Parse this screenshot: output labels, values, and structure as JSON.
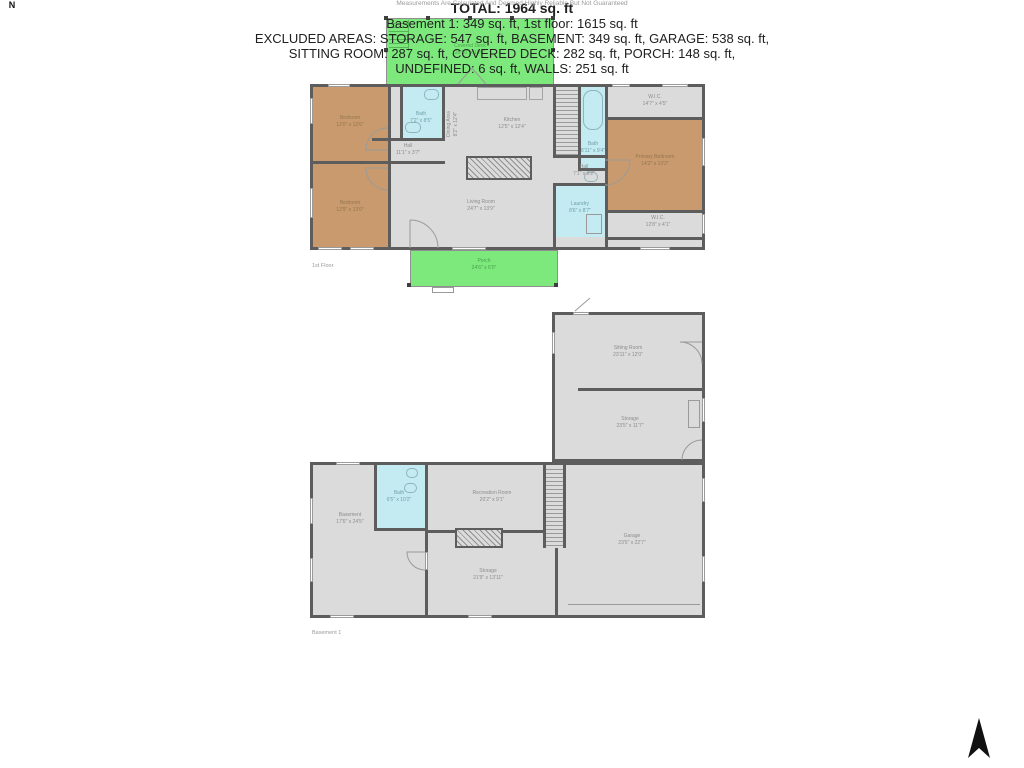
{
  "page": {
    "floor1_label": "1st Floor",
    "basement_label": "Basement 1"
  },
  "floor1": {
    "rooms": {
      "covered_deck": {
        "name": "Covered Deck",
        "dims": "26'10\" x 10'6\""
      },
      "bedroom_top": {
        "name": "Bedroom",
        "dims": "12'0\" x 12'6\""
      },
      "bath_left": {
        "name": "Bath",
        "dims": "7'2\" x 8'5\""
      },
      "hall_left": {
        "name": "Hall",
        "dims": "11'1\" x 3'7\""
      },
      "dining_area": {
        "name": "Dining Area",
        "dims": "8'2\" x 12'4\""
      },
      "kitchen": {
        "name": "Kitchen",
        "dims": "12'5\" x 12'4\""
      },
      "bath_right": {
        "name": "Bath",
        "dims": "8'11\" x 9'4\""
      },
      "wic_top": {
        "name": "W.I.C.",
        "dims": "14'7\" x 4'5\""
      },
      "primary_bedroom": {
        "name": "Primary Bedroom",
        "dims": "14'2\" x 13'2\""
      },
      "wic_bottom": {
        "name": "W.I.C.",
        "dims": "12'8\" x 4'1\""
      },
      "hall_right": {
        "name": "Hall",
        "dims": "7'1\" x 6'2\""
      },
      "laundry": {
        "name": "Laundry",
        "dims": "8'6\" x 8'7\""
      },
      "living_room": {
        "name": "Living Room",
        "dims": "24'7\" x 13'9\""
      },
      "bedroom_bottom": {
        "name": "Bedroom",
        "dims": "12'9\" x 13'0\""
      },
      "porch": {
        "name": "Porch",
        "dims": "24'6\" x 6'0\""
      }
    }
  },
  "basement": {
    "rooms": {
      "sitting_room": {
        "name": "Sitting Room",
        "dims": "23'11\" x 12'0\""
      },
      "storage_upper": {
        "name": "Storage",
        "dims": "23'5\" x 11'7\""
      },
      "basement_room": {
        "name": "Basement",
        "dims": "17'6\" x 24'5\""
      },
      "bath": {
        "name": "Bath",
        "dims": "6'5\" x 10'2\""
      },
      "recreation": {
        "name": "Recreation Room",
        "dims": "20'2\" x 9'1\""
      },
      "storage_lower": {
        "name": "Storage",
        "dims": "21'9\" x 13'11\""
      },
      "garage": {
        "name": "Garage",
        "dims": "23'5\" x 22'7\""
      }
    }
  },
  "summary": {
    "total": "TOTAL: 1964 sq. ft",
    "floors": "Basement 1: 349 sq. ft, 1st floor: 1615 sq. ft",
    "excluded1": "EXCLUDED AREAS: STORAGE: 547 sq. ft, BASEMENT: 349 sq. ft, GARAGE: 538 sq. ft,",
    "excluded2": "SITTING ROOM: 287 sq. ft, COVERED DECK: 282 sq. ft, PORCH: 148 sq. ft,",
    "excluded3": "UNDEFINED: 6 sq. ft, WALLS: 251 sq. ft",
    "disclaimer": "Measurements Are Calculated And Deemed Highly Reliable But Not Guaranteed"
  },
  "compass": {
    "north": "N"
  },
  "colors": {
    "deck_porch_green": "#7de97d",
    "bedroom_tan": "#c89a6d",
    "bath_blue": "#c4ebf2",
    "floor_gray": "#dbdbdb",
    "wall_gray": "#5d5d5d",
    "label_gray": "#8d8d8d"
  }
}
